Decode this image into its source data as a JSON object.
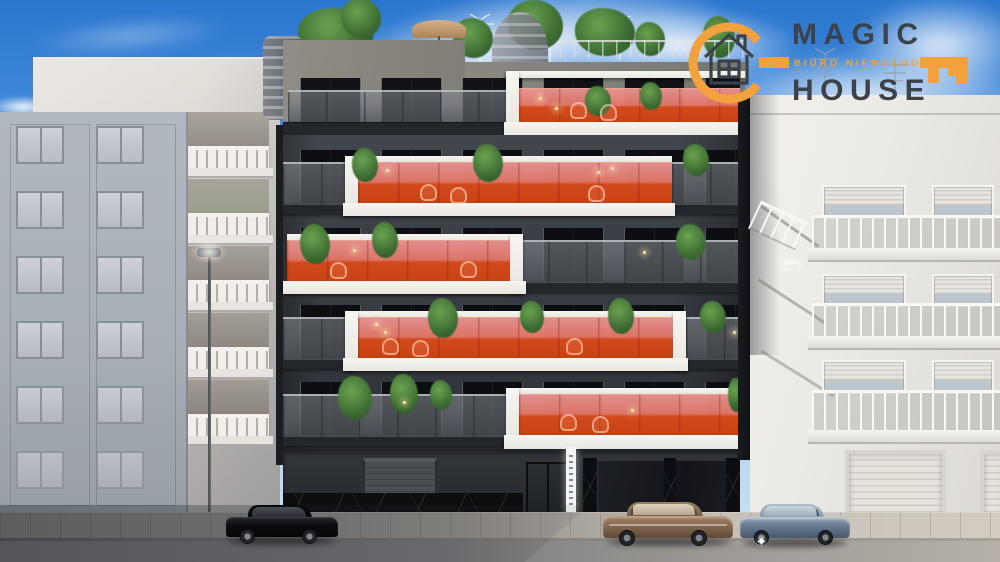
{
  "logo": {
    "line1": "MAGIC",
    "line2": "HOUSE",
    "tagline": "BIURO NIERUCHOMOŚCI"
  },
  "palette": {
    "accent_orange": "#F2A13C",
    "logo_text": "#3B424A",
    "balcony_glass_orange": "#D24A1C",
    "balcony_frame_white": "#F4F2EE",
    "featured_facade_dark": "#34383E",
    "neighbor_white": "#E9E5E0",
    "neighbor_gray_blue": "#A9B2BA",
    "sky_top": "#2A76CF"
  }
}
